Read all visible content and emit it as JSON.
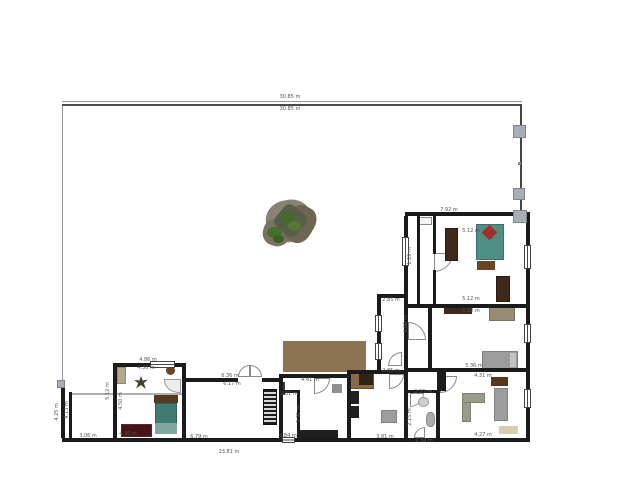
{
  "plan": {
    "background": "#ffffff",
    "wall_color": "#1b1b1b",
    "plot_lines": [
      [
        62,
        101,
        460,
        1,
        "#9a9a9a"
      ],
      [
        62,
        104,
        460,
        2,
        "#4a4a4a"
      ],
      [
        62,
        106,
        1,
        277,
        "#9a9a9a"
      ],
      [
        520,
        106,
        2,
        108,
        "#444444"
      ]
    ],
    "fence_posts": [
      [
        513,
        125,
        13,
        13
      ],
      [
        513,
        188,
        12,
        12
      ],
      [
        513,
        210,
        14,
        13
      ],
      [
        518,
        162,
        3,
        3
      ],
      [
        57,
        380,
        8,
        8
      ]
    ],
    "walls": [
      [
        405,
        212,
        125,
        4
      ],
      [
        526,
        216,
        4,
        226
      ],
      [
        404,
        216,
        4,
        92
      ],
      [
        417,
        216,
        3,
        88
      ],
      [
        433,
        216,
        3,
        38
      ],
      [
        433,
        270,
        3,
        34
      ],
      [
        404,
        304,
        126,
        4
      ],
      [
        428,
        308,
        4,
        64
      ],
      [
        404,
        308,
        4,
        64
      ],
      [
        377,
        294,
        4,
        78
      ],
      [
        377,
        294,
        30,
        4
      ],
      [
        428,
        368,
        102,
        4
      ],
      [
        404,
        368,
        36,
        4
      ],
      [
        347,
        370,
        61,
        4
      ],
      [
        347,
        370,
        4,
        70
      ],
      [
        404,
        374,
        4,
        66
      ],
      [
        436,
        390,
        4,
        50
      ],
      [
        406,
        390,
        30,
        3
      ],
      [
        279,
        374,
        68,
        4
      ],
      [
        279,
        378,
        4,
        62
      ],
      [
        297,
        390,
        3,
        48
      ],
      [
        279,
        390,
        20,
        3
      ],
      [
        186,
        378,
        52,
        4
      ],
      [
        262,
        378,
        17,
        4
      ],
      [
        113,
        363,
        73,
        4
      ],
      [
        113,
        367,
        4,
        73
      ],
      [
        182,
        367,
        4,
        73
      ],
      [
        62,
        438,
        468,
        4
      ],
      [
        61,
        383,
        4,
        55
      ],
      [
        69,
        392,
        3,
        46
      ]
    ],
    "windows": [
      [
        524,
        245,
        7,
        24,
        "v"
      ],
      [
        524,
        324,
        7,
        19,
        "v"
      ],
      [
        524,
        389,
        7,
        19,
        "v"
      ],
      [
        402,
        237,
        7,
        29,
        "v"
      ],
      [
        375,
        315,
        7,
        17,
        "v"
      ],
      [
        375,
        343,
        7,
        17,
        "v"
      ],
      [
        150,
        361,
        25,
        7,
        "h"
      ],
      [
        282,
        437,
        13,
        6,
        "h"
      ]
    ],
    "doors": [
      [
        434,
        253,
        19,
        "br"
      ],
      [
        408,
        322,
        18,
        "tr"
      ],
      [
        440,
        376,
        17,
        "br"
      ],
      [
        410,
        393,
        14,
        "br"
      ],
      [
        414,
        427,
        11,
        "tl"
      ],
      [
        349,
        374,
        15,
        "bl"
      ],
      [
        389,
        374,
        15,
        "br"
      ],
      [
        314,
        378,
        16,
        "br"
      ],
      [
        238,
        365,
        12,
        "tl"
      ],
      [
        250,
        365,
        12,
        "tr"
      ],
      [
        388,
        352,
        14,
        "tl"
      ]
    ],
    "labels": [
      [
        "30.85 m",
        290,
        97,
        0
      ],
      [
        "30.85 m",
        290,
        109,
        0
      ],
      [
        "7.92 m",
        449,
        210,
        0
      ],
      [
        "5.12 m",
        471,
        231,
        0
      ],
      [
        "5.12 m",
        471,
        299,
        0
      ],
      [
        "5.12 m",
        471,
        311,
        0
      ],
      [
        "5.36 m",
        474,
        366,
        0
      ],
      [
        "4.31 m",
        483,
        376,
        0
      ],
      [
        "4.27 m",
        483,
        435,
        0
      ],
      [
        "2.33 m",
        423,
        392,
        0
      ],
      [
        "2.15 m",
        410,
        417,
        1
      ],
      [
        "2.34 m",
        424,
        441,
        0
      ],
      [
        "2.85 m",
        391,
        300,
        0
      ],
      [
        "2.85 m",
        391,
        371,
        0
      ],
      [
        "4.06 m",
        406,
        324,
        1
      ],
      [
        "1.19 m",
        410,
        256,
        1
      ],
      [
        "3.81 m",
        385,
        437,
        0
      ],
      [
        "4.41 m",
        310,
        380,
        0
      ],
      [
        "2.01 m",
        289,
        394,
        0
      ],
      [
        "1.91 m",
        299,
        414,
        1
      ],
      [
        "0.84 m",
        288,
        436,
        0
      ],
      [
        "6.36 m",
        230,
        376,
        0
      ],
      [
        "6.17 m",
        232,
        384,
        0
      ],
      [
        "6.79 m",
        199,
        437,
        0
      ],
      [
        "4.86 m",
        148,
        360,
        0
      ],
      [
        "4.36 m",
        146,
        368,
        0
      ],
      [
        "4.36 m",
        128,
        434,
        0
      ],
      [
        "5.12 m",
        108,
        391,
        1
      ],
      [
        "4.50 m",
        121,
        401,
        1
      ],
      [
        "3.06 m",
        88,
        436,
        0
      ],
      [
        "4.25 m",
        57,
        412,
        1
      ],
      [
        "4.13 m",
        67,
        410,
        1
      ],
      [
        "23.81 m",
        229,
        452,
        0
      ]
    ],
    "furniture": [
      {
        "name": "terrace-deck",
        "x": 283,
        "y": 341,
        "w": 83,
        "h": 31,
        "c": "#8c7453",
        "k": "terrace"
      },
      {
        "name": "stairs",
        "x": 263,
        "y": 389,
        "w": 14,
        "h": 36,
        "k": "stairs"
      },
      {
        "name": "pergola-beam",
        "x": 70,
        "y": 393,
        "w": 116,
        "h": 2,
        "c": "#b0b0b0"
      },
      {
        "name": "wardrobe-left",
        "x": 445,
        "y": 228,
        "w": 13,
        "h": 33,
        "c": "#40281a",
        "b": "#2a1a10"
      },
      {
        "name": "double-bed",
        "x": 476,
        "y": 224,
        "w": 28,
        "h": 36,
        "c": "#4e8e85",
        "b": "#3c7068"
      },
      {
        "name": "bed-pillow-diamond",
        "x": 484,
        "y": 227,
        "w": 11,
        "h": 11,
        "c": "#a03028",
        "rot": 45
      },
      {
        "name": "bed-bench",
        "x": 477,
        "y": 261,
        "w": 18,
        "h": 9,
        "c": "#6a4525"
      },
      {
        "name": "wardrobe-right",
        "x": 496,
        "y": 276,
        "w": 14,
        "h": 26,
        "c": "#40281a",
        "b": "#2a1a10"
      },
      {
        "name": "entry-cabinet",
        "x": 419,
        "y": 217,
        "w": 13,
        "h": 8,
        "c": "#f4f4f4",
        "b": "#888888"
      },
      {
        "name": "dresser",
        "x": 444,
        "y": 306,
        "w": 28,
        "h": 8,
        "c": "#40281a"
      },
      {
        "name": "desk",
        "x": 489,
        "y": 306,
        "w": 26,
        "h": 15,
        "c": "#968c74",
        "b": "#7a7158"
      },
      {
        "name": "single-bed",
        "x": 482,
        "y": 351,
        "w": 36,
        "h": 19,
        "c": "#9d9d9d",
        "b": "#7f7f7f"
      },
      {
        "name": "bed-pillow",
        "x": 510,
        "y": 353,
        "w": 6,
        "h": 14,
        "c": "#c4c4c4"
      },
      {
        "name": "tv-cabinet",
        "x": 491,
        "y": 377,
        "w": 17,
        "h": 9,
        "c": "#57361c"
      },
      {
        "name": "sofa-l-part-v",
        "x": 462,
        "y": 393,
        "w": 9,
        "h": 29,
        "c": "#999b8b",
        "b": "#7e8070"
      },
      {
        "name": "sofa-l-part-h",
        "x": 462,
        "y": 393,
        "w": 23,
        "h": 10,
        "c": "#999b8b",
        "b": "#7e8070"
      },
      {
        "name": "wall-unit",
        "x": 494,
        "y": 388,
        "w": 14,
        "h": 33,
        "c": "#9d9d9d",
        "b": "#808080"
      },
      {
        "name": "living-rug",
        "x": 499,
        "y": 426,
        "w": 19,
        "h": 8,
        "c": "#d6cdb2"
      },
      {
        "name": "heater-column",
        "x": 437,
        "y": 370,
        "w": 9,
        "h": 21,
        "c": "#1c1c1c"
      },
      {
        "name": "bath-sink",
        "x": 418,
        "y": 397,
        "w": 11,
        "h": 10,
        "c": "#cfcfcf",
        "b": "#9a9a9a",
        "r": "50%"
      },
      {
        "name": "toilet",
        "x": 426,
        "y": 412,
        "w": 9,
        "h": 15,
        "c": "#ababab",
        "b": "#8a8a8a",
        "r": "40%"
      },
      {
        "name": "kitchen-counter",
        "x": 348,
        "y": 372,
        "w": 26,
        "h": 17,
        "c": "#8a6848",
        "b": "#6b4f35"
      },
      {
        "name": "kitchen-counter-dark",
        "x": 359,
        "y": 374,
        "w": 14,
        "h": 11,
        "c": "#302417"
      },
      {
        "name": "kitchen-appliance-1",
        "x": 349,
        "y": 391,
        "w": 10,
        "h": 13,
        "c": "#202020"
      },
      {
        "name": "kitchen-appliance-2",
        "x": 349,
        "y": 406,
        "w": 10,
        "h": 12,
        "c": "#202020"
      },
      {
        "name": "kitchen-table",
        "x": 381,
        "y": 410,
        "w": 16,
        "h": 13,
        "c": "#9d9d9d",
        "b": "#828282"
      },
      {
        "name": "cabinet-dark",
        "x": 279,
        "y": 382,
        "w": 6,
        "h": 13,
        "c": "#3a3a3a"
      },
      {
        "name": "wall-shelf",
        "x": 332,
        "y": 384,
        "w": 10,
        "h": 9,
        "c": "#8f8f8f"
      },
      {
        "name": "bench-dark",
        "x": 300,
        "y": 430,
        "w": 38,
        "h": 8,
        "c": "#1f1f1f"
      },
      {
        "name": "tall-cabinet",
        "x": 117,
        "y": 367,
        "w": 9,
        "h": 17,
        "c": "#b2a88e",
        "b": "#948a6e"
      },
      {
        "name": "round-table",
        "x": 166,
        "y": 366,
        "w": 9,
        "h": 9,
        "c": "#6a4525",
        "r": "50%"
      },
      {
        "name": "eagle-decor",
        "x": 134,
        "y": 376,
        "w": 14,
        "h": 13,
        "c": "#4a4030",
        "k": "eagle"
      },
      {
        "name": "corner-sink",
        "x": 164,
        "y": 379,
        "w": 17,
        "h": 14,
        "c": "#ececec",
        "b": "#9a9a9a",
        "r": "0 0 0 90%"
      },
      {
        "name": "red-rug",
        "x": 121,
        "y": 424,
        "w": 31,
        "h": 13,
        "c": "#47121a",
        "b": "#6a2028"
      },
      {
        "name": "bed-headboard",
        "x": 154,
        "y": 395,
        "w": 24,
        "h": 8,
        "c": "#573a22"
      },
      {
        "name": "teal-bed",
        "x": 155,
        "y": 403,
        "w": 22,
        "h": 21,
        "c": "#3f7a73",
        "b": "#2f5f59"
      },
      {
        "name": "bed-blanket",
        "x": 155,
        "y": 423,
        "w": 22,
        "h": 11,
        "c": "#7fa79e"
      }
    ],
    "tree": [
      {
        "x": 266,
        "y": 200,
        "w": 46,
        "h": 42,
        "c": "#8b8172",
        "r": "45%",
        "rot": -12
      },
      {
        "x": 263,
        "y": 219,
        "w": 27,
        "h": 27,
        "c": "#7c7263",
        "r": "45%",
        "rot": 18
      },
      {
        "x": 285,
        "y": 205,
        "w": 29,
        "h": 38,
        "c": "#6f6553",
        "r": "40%",
        "rot": 30
      },
      {
        "x": 277,
        "y": 207,
        "w": 27,
        "h": 27,
        "c": "#565e45",
        "r": "25%",
        "rot": 40
      },
      {
        "x": 281,
        "y": 212,
        "w": 14,
        "h": 11,
        "c": "#47682c",
        "r": "50%"
      },
      {
        "x": 288,
        "y": 221,
        "w": 13,
        "h": 10,
        "c": "#557733",
        "r": "50%"
      },
      {
        "x": 267,
        "y": 227,
        "w": 15,
        "h": 11,
        "c": "#44702e",
        "r": "50%"
      },
      {
        "x": 273,
        "y": 235,
        "w": 11,
        "h": 8,
        "c": "#3c5f28",
        "r": "50%"
      }
    ]
  }
}
